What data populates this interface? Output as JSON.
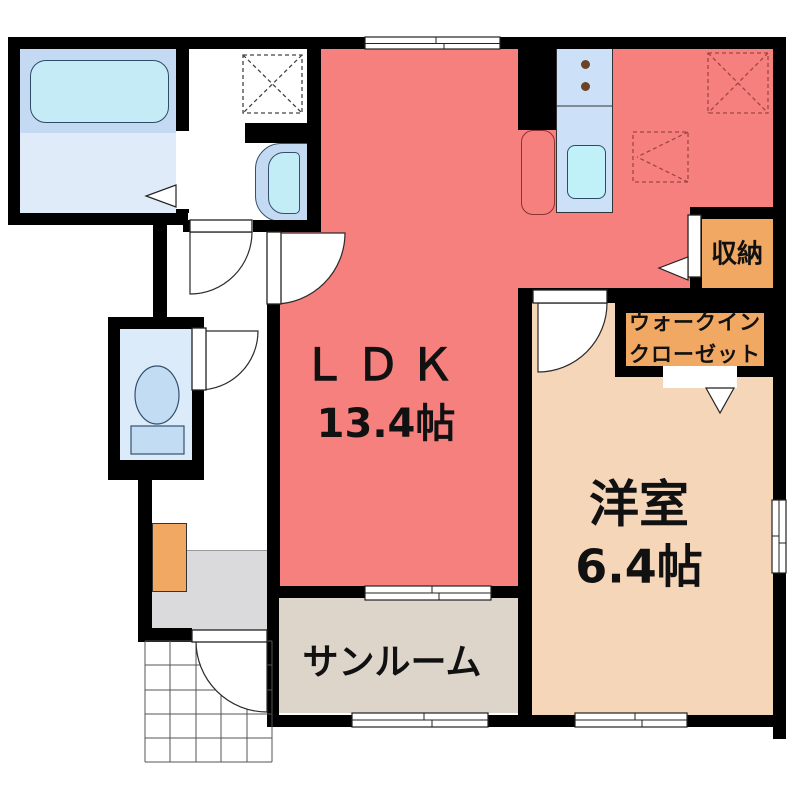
{
  "rooms": {
    "ldk": {
      "label": "ＬＤＫ",
      "area": "13.4帖"
    },
    "western": {
      "label": "洋室",
      "area": "6.4帖"
    },
    "sunroom": {
      "label": "サンルーム"
    },
    "wic": {
      "line1": "ウォークイン",
      "line2": "クローゼット"
    },
    "storage": {
      "label": "収納"
    }
  },
  "colors": {
    "ldk_red": "#F5807E",
    "western_peach": "#F5D6B9",
    "sunroom_beige": "#DED5CA",
    "closet_orange": "#F0A862",
    "entrance_gray": "#DADADC",
    "wall_black": "#000000",
    "bath_blue": "#C3DAF2",
    "bath_floor_blue": "#DFEBF8",
    "fixture_cyan": "#C2ECF6",
    "toilet_room_blue": "#DCEBFA",
    "kitchen_blue": "#CCE1F7"
  }
}
